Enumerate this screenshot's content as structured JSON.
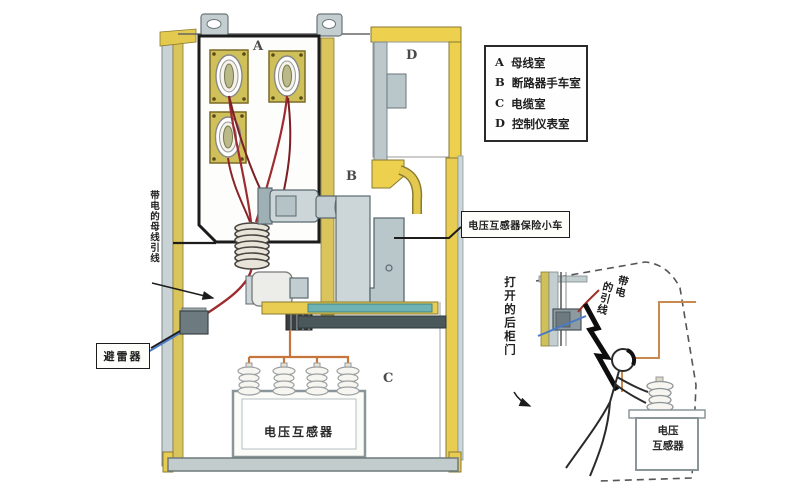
{
  "legend": {
    "items": [
      {
        "key": "A",
        "name": "母线室"
      },
      {
        "key": "B",
        "name": "断路器手车室"
      },
      {
        "key": "C",
        "name": "电缆室"
      },
      {
        "key": "D",
        "name": "控制仪表室"
      }
    ]
  },
  "compartments": {
    "a": "A",
    "b": "B",
    "c": "C",
    "d": "D"
  },
  "labels": {
    "live_busbar_lead": "带电的母线引线",
    "arrester": "避雷器",
    "vt_fuse_cart": "电压互感器保险小车",
    "voltage_transformer": "电压互感器",
    "opened_rear_door": "打开的后柜门",
    "live_lead_col_right": "带电",
    "live_lead_col_left": "的引线",
    "inset_vt_line1": "电压",
    "inset_vt_line2": "互感器"
  },
  "colors": {
    "cabinet_yellow": "#e3c94e",
    "olive_wall": "#d9c55c",
    "panel_gray": "#c3ced1",
    "steel_gray": "#b9c6ca",
    "teal_strip": "#6fb3b5",
    "wire_red": "#9e2b30",
    "wire_orange": "#c6763d",
    "wire_blue": "#4a7ac8",
    "outline_black": "#1c1c1c"
  }
}
